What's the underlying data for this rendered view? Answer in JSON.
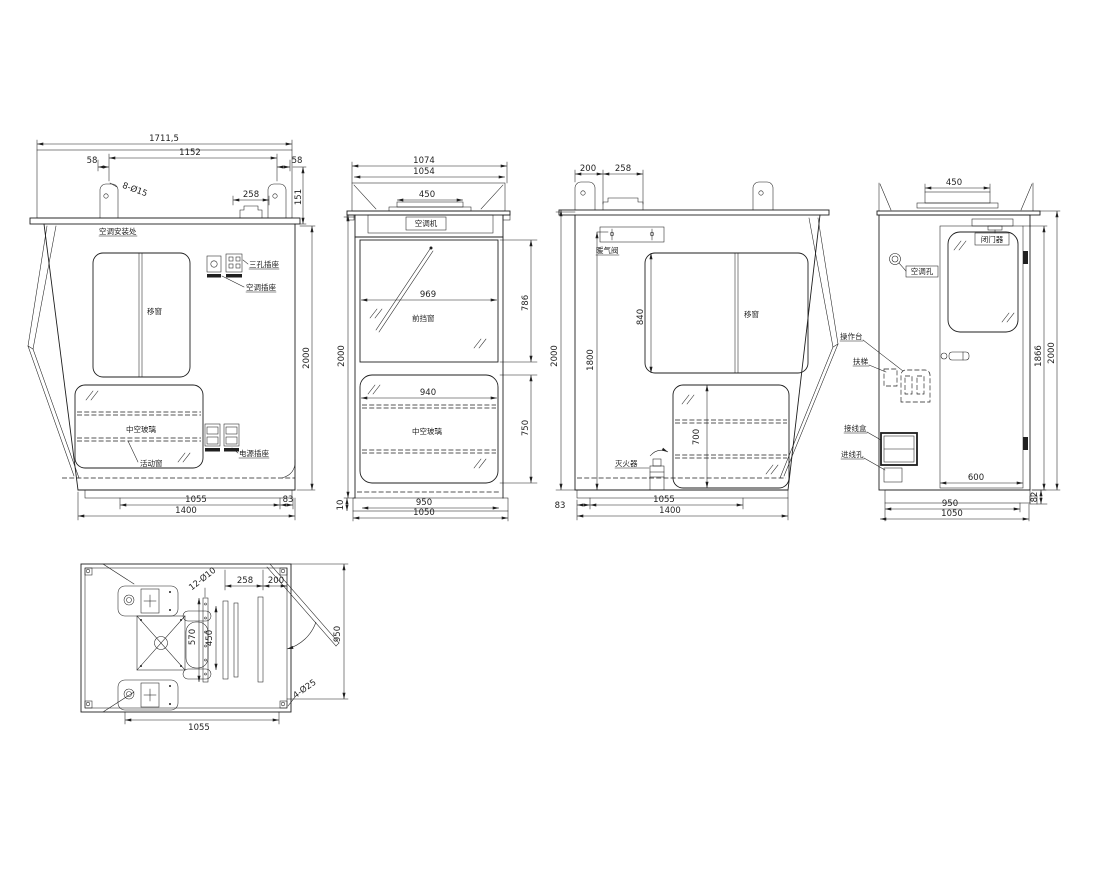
{
  "meta": {
    "type": "engineering-drawing-operator-cab",
    "units": "mm",
    "line_color": "#1f1f1f",
    "background": "#ffffff"
  },
  "views": {
    "rear": {
      "dims": {
        "overall": "1711,5",
        "span": "1152",
        "left": "58",
        "right": "58",
        "holes": "8-Ø15",
        "duct": "258",
        "roof": "151",
        "height": "2000",
        "floor": "1055",
        "edge": "83",
        "base": "1400"
      },
      "labels": {
        "ac": "空调安装处",
        "s1": "三孔插座",
        "s2": "空调插座",
        "win": "移窗",
        "glass": "中空玻璃",
        "vent": "活动窗",
        "power": "电源插座"
      }
    },
    "front": {
      "dims": {
        "w1": "1074",
        "w2": "1054",
        "ac": "450",
        "wsw": "969",
        "wsh": "786",
        "height": "2000",
        "lw": "940",
        "lh": "750",
        "inner": "950",
        "base": "1050",
        "plate": "10"
      },
      "labels": {
        "ac": "空调机",
        "ws": "前挡窗",
        "glass": "中空玻璃"
      }
    },
    "left": {
      "dims": {
        "a": "200",
        "b": "258",
        "height": "2000",
        "inner": "1800",
        "win": "840",
        "low": "700",
        "edge": "83",
        "floor": "1055",
        "base": "1400"
      },
      "labels": {
        "valve": "暖气阀",
        "win": "移窗",
        "ext": "灭火器"
      }
    },
    "door": {
      "dims": {
        "ac": "450",
        "door_h": "1866",
        "height": "2000",
        "door_w": "600",
        "step": "82",
        "inner": "950",
        "base": "1050"
      },
      "labels": {
        "closer": "闭门器",
        "hole": "空调孔",
        "console": "操作台",
        "ladder": "扶梯",
        "jbox": "接线盒",
        "inlet": "进线孔"
      }
    },
    "plan": {
      "dims": {
        "rail_holes": "12-Ø10",
        "a": "258",
        "b": "200",
        "r1": "570",
        "r2": "450",
        "depth": "950",
        "base_holes": "4-Ø25",
        "width": "1055"
      }
    }
  }
}
